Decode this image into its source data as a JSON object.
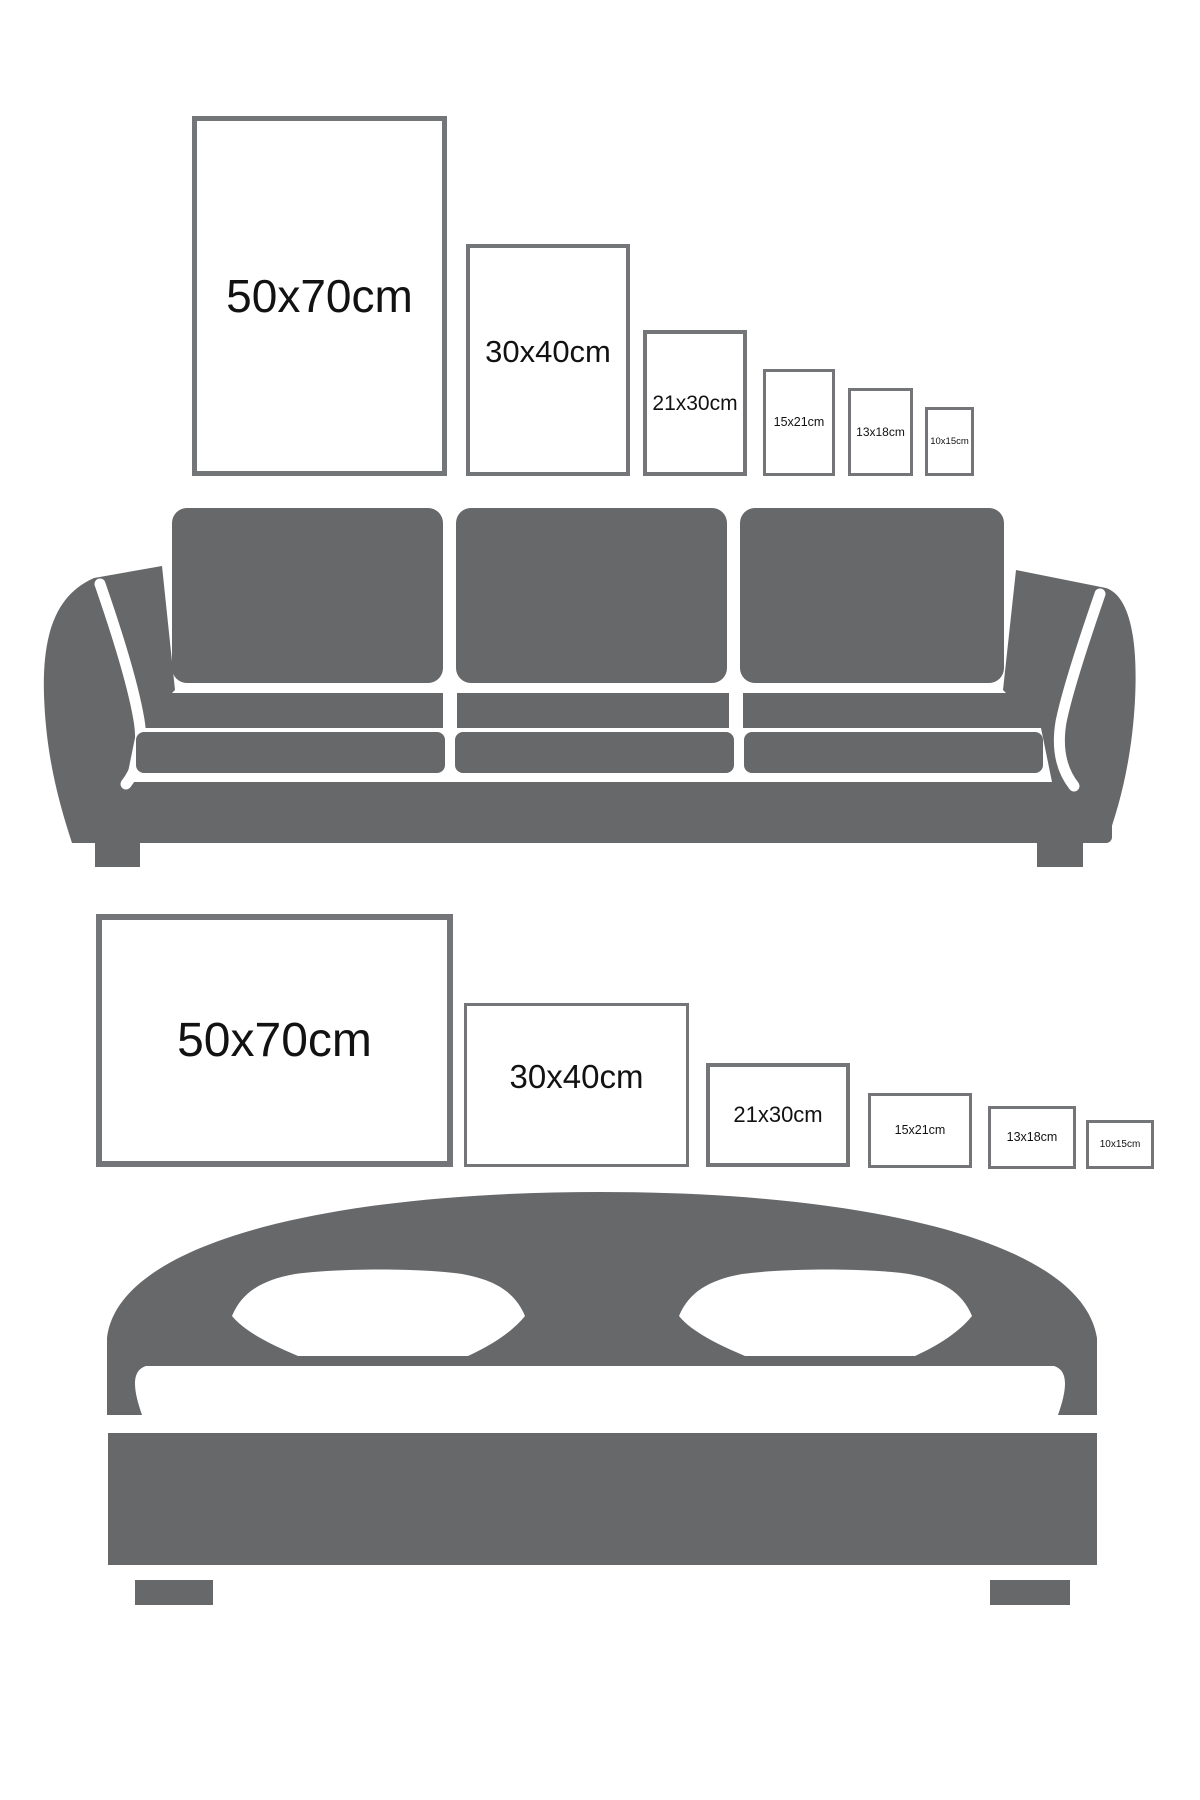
{
  "colors": {
    "background": "#ffffff",
    "furniture_gray": "#67686a",
    "frame_border_gray": "#747578",
    "label_text": "#121212"
  },
  "top_section": {
    "furniture": "sofa",
    "orientation": "portrait",
    "frames": [
      {
        "label": "50x70cm"
      },
      {
        "label": "30x40cm"
      },
      {
        "label": "21x30cm"
      },
      {
        "label": "15x21cm"
      },
      {
        "label": "13x18cm"
      },
      {
        "label": "10x15cm"
      }
    ]
  },
  "bottom_section": {
    "furniture": "bed",
    "orientation": "landscape",
    "frames": [
      {
        "label": "50x70cm"
      },
      {
        "label": "30x40cm"
      },
      {
        "label": "21x30cm"
      },
      {
        "label": "15x21cm"
      },
      {
        "label": "13x18cm"
      },
      {
        "label": "10x15cm"
      }
    ]
  }
}
